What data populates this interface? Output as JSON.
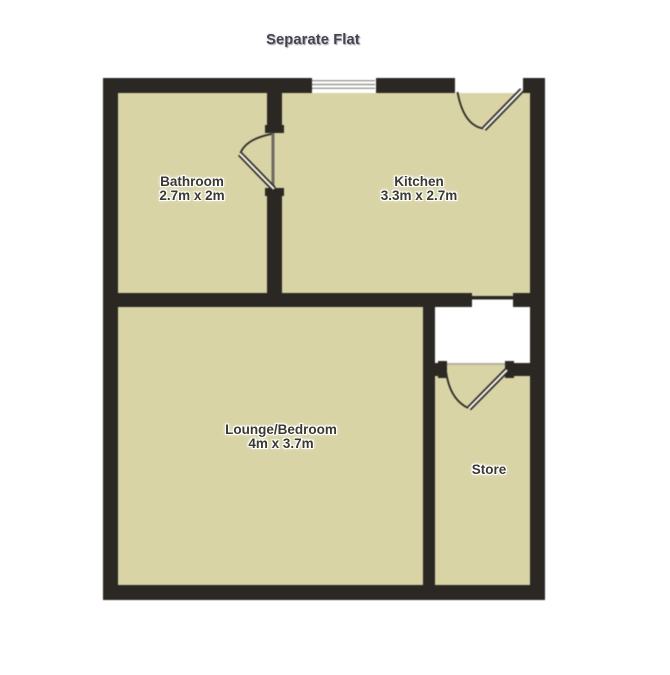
{
  "title": "Separate Flat",
  "colors": {
    "background": "#ffffff",
    "floor": "#d8d4a6",
    "wall": "#2b2824"
  },
  "rooms": {
    "bathroom": {
      "name": "Bathroom",
      "dimensions": "2.7m x 2m"
    },
    "kitchen": {
      "name": "Kitchen",
      "dimensions": "3.3m x 2.7m"
    },
    "lounge": {
      "name": "Lounge/Bedroom",
      "dimensions": "4m x 3.7m"
    },
    "store": {
      "name": "Store"
    }
  }
}
